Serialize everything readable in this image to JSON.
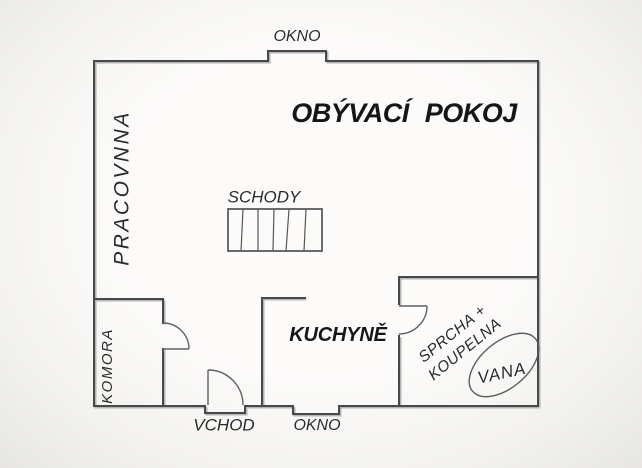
{
  "floorplan": {
    "rooms": {
      "living_room": "OBÝVACÍ POKOJ",
      "study": "PRACOVNNA",
      "kitchen": "KUCHYNĚ",
      "pantry": "KOMORA",
      "stairs": "SCHODY",
      "bathroom": {
        "line1": "SPRCHA +",
        "line2": "KOUPELNA"
      },
      "bathtub": "VANA"
    },
    "openings": {
      "window_top": "OKNO",
      "window_bottom": "OKNO",
      "entrance": "VCHOD"
    },
    "colors": {
      "wall_dark": "#484848",
      "wall_light": "#b4b4b4",
      "door_line": "#616161",
      "fixture_line": "#5c5c5c",
      "text": "#222222",
      "background": "#f6f5f2"
    }
  }
}
